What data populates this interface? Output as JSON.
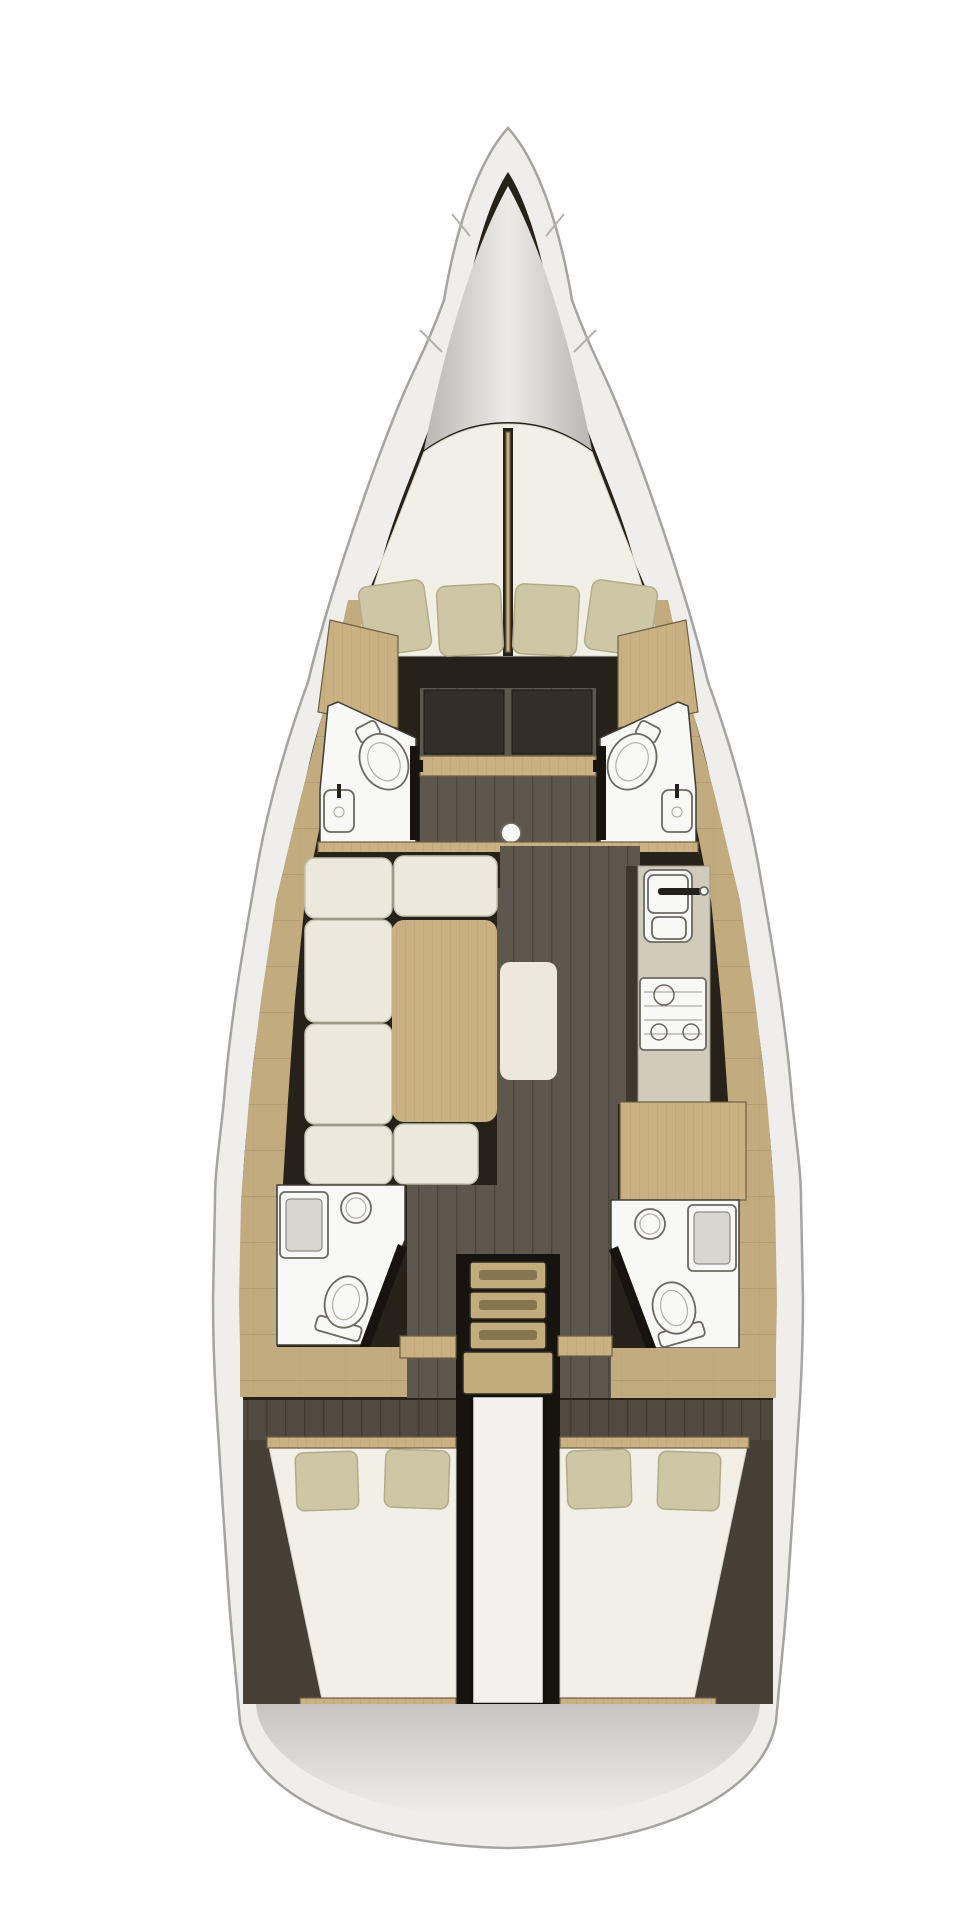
{
  "canvas": {
    "width": 959,
    "height": 1919
  },
  "document": {
    "type": "sailing yacht interior floor plan",
    "view": "top-down, bow at top",
    "visible_text": ""
  },
  "colors": {
    "page_bg": "#ffffff",
    "hull_fill": "#efeeec",
    "hull_stroke": "#a5a4a1",
    "interior_dark": "#262219",
    "notch": "#b3b2ae",
    "berth": "#f2efe6",
    "berth_stroke": "#d6d3c6",
    "pillow": "#cec7a5",
    "pillow_stroke": "#b3ab88",
    "wood": "#c9b183",
    "wood_line": "#bca271",
    "wood_edge": "#6d5f41",
    "deck": "#c2ab7f",
    "deck_line": "#b09a71",
    "floor": "#5d564d",
    "floor_line": "#4b453d",
    "floor_dark": "#514a40",
    "floor_dark_line": "#403a31",
    "wedge": "#463f35",
    "cushion": "#ece9dc",
    "cushion_stroke": "#c7c2b0",
    "counter": "#d1cbbc",
    "cabinet_front": "#3c362c",
    "fixture": "#f8f8f6",
    "fixture_stroke": "#6b6962",
    "shower_tray": "#d7d6d1",
    "door_dark": "#17140f",
    "corridor_door": "#332f28",
    "step": "#c3ac7c",
    "step_slot": "#857651",
    "engine": "#f2f1ee",
    "faucet": "#23201a",
    "stern_from": "#c6c5c1",
    "stern_to": "#f0efed",
    "cone_edge": "#b8b7b3",
    "cone_mid": "#ecebe7"
  },
  "inventory": {
    "bow": {
      "anchor_locker": 1
    },
    "forward_cabin": {
      "berths": 2,
      "pillows": 4,
      "wardrobes": 2
    },
    "forward_heads": [
      {
        "side": "port",
        "toilet": 1,
        "sink": 1,
        "door": 1
      },
      {
        "side": "starboard",
        "toilet": 1,
        "sink": 1,
        "door": 1
      }
    ],
    "corridor": {
      "mast_post": 1,
      "cabin_doors": 2,
      "cross_beam": 1
    },
    "salon": {
      "sofa_cushions": 6,
      "table": 1,
      "center_bench": 1
    },
    "galley": {
      "sink_basins": 2,
      "faucet": 1,
      "stove_burners": 3,
      "nav_desk": 1
    },
    "aft_heads": [
      {
        "side": "port",
        "toilet": 1,
        "sink": 1,
        "shower": 1,
        "door": 1
      },
      {
        "side": "starboard",
        "toilet": 1,
        "sink": 1,
        "shower": 1,
        "door": 1
      }
    ],
    "companionway": {
      "steps": 4
    },
    "engine_compartment": 1,
    "aft_cabins": [
      {
        "side": "port",
        "berth": "double",
        "pillows": 2
      },
      {
        "side": "starboard",
        "berth": "double",
        "pillows": 2
      }
    ],
    "stern": {
      "transom_deck": 1
    }
  }
}
